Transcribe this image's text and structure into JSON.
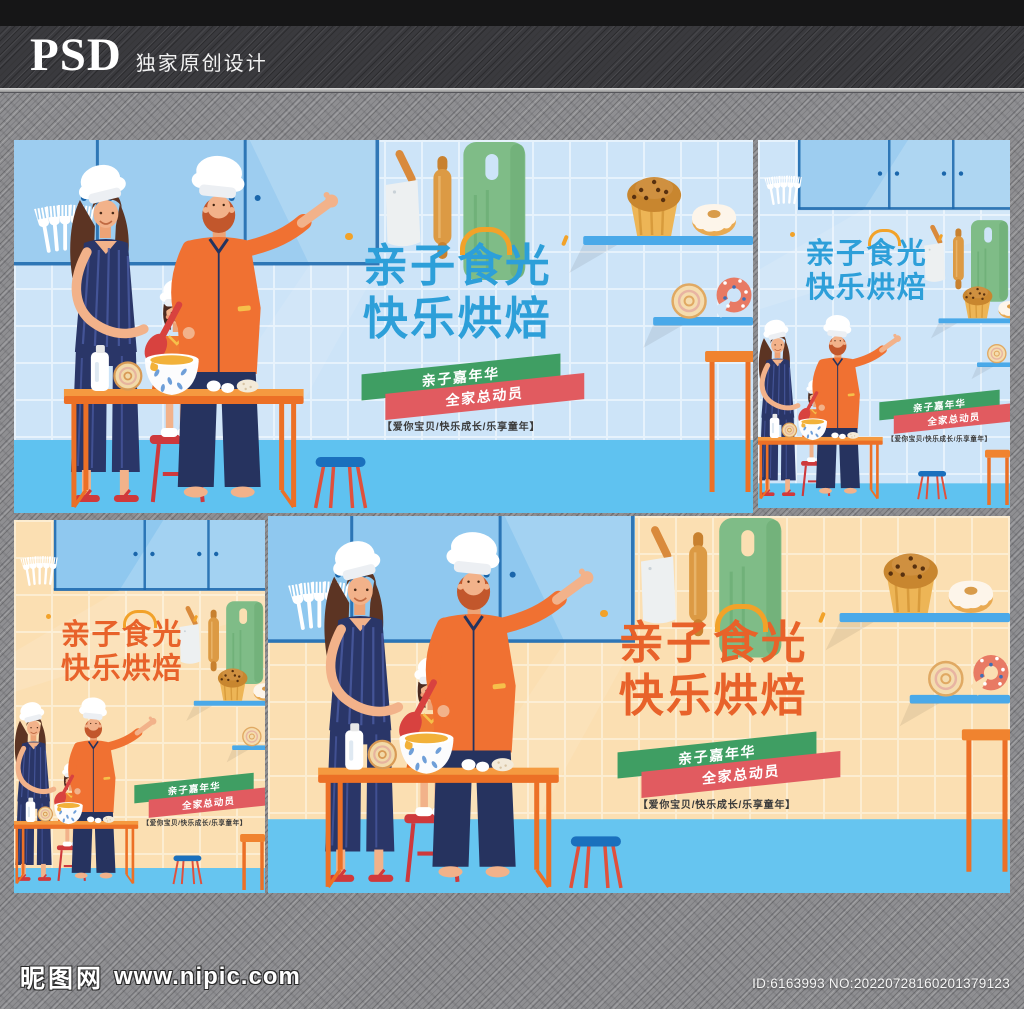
{
  "header": {
    "logo": "PSD",
    "subtitle": "独家原创设计"
  },
  "footer": {
    "site_name": "昵图网",
    "site_url": "www.nipic.com",
    "id_text": "ID:6163993 NO:20220728160201379123"
  },
  "poster": {
    "title_line1": "亲子食光",
    "title_line2": "快乐烘焙",
    "ribbon1": "亲子嘉年华",
    "ribbon2": "全家总动员",
    "tagline": "【爱你宝贝/快乐成长/乐享童年】"
  },
  "posters": [
    {
      "name": "poster-blue-landscape",
      "layout": "wide",
      "theme": "blue"
    },
    {
      "name": "poster-blue-portrait",
      "layout": "tall",
      "theme": "blue"
    },
    {
      "name": "poster-orange-portrait",
      "layout": "tall",
      "theme": "orange"
    },
    {
      "name": "poster-orange-landscape",
      "layout": "wide",
      "theme": "orange"
    }
  ],
  "themes": {
    "blue": {
      "wall": "#cde4f8",
      "grid": "#e6f2fc",
      "cabinet": "#9dcdf0",
      "cabinet_line": "#1a66ab",
      "floor": "#5fc2f0",
      "shelf": "#4aa9e9",
      "title": "#2d9fd9",
      "accent": "#f2a229"
    },
    "orange": {
      "wall": "#fbdfb2",
      "grid": "#fcedd1",
      "cabinet": "#8fc8ef",
      "cabinet_line": "#1a66ab",
      "floor": "#66c5f0",
      "shelf": "#4aa9e9",
      "title": "#e8622a",
      "accent": "#f2a229"
    }
  },
  "colors": {
    "ribbon_green": "#3f9e63",
    "ribbon_pink": "#e15b60",
    "tagline_text": "#3b3b3b",
    "table_orange": "#ec7026",
    "stool_red": "#ce393c",
    "background_gray": "#8f8f92"
  }
}
